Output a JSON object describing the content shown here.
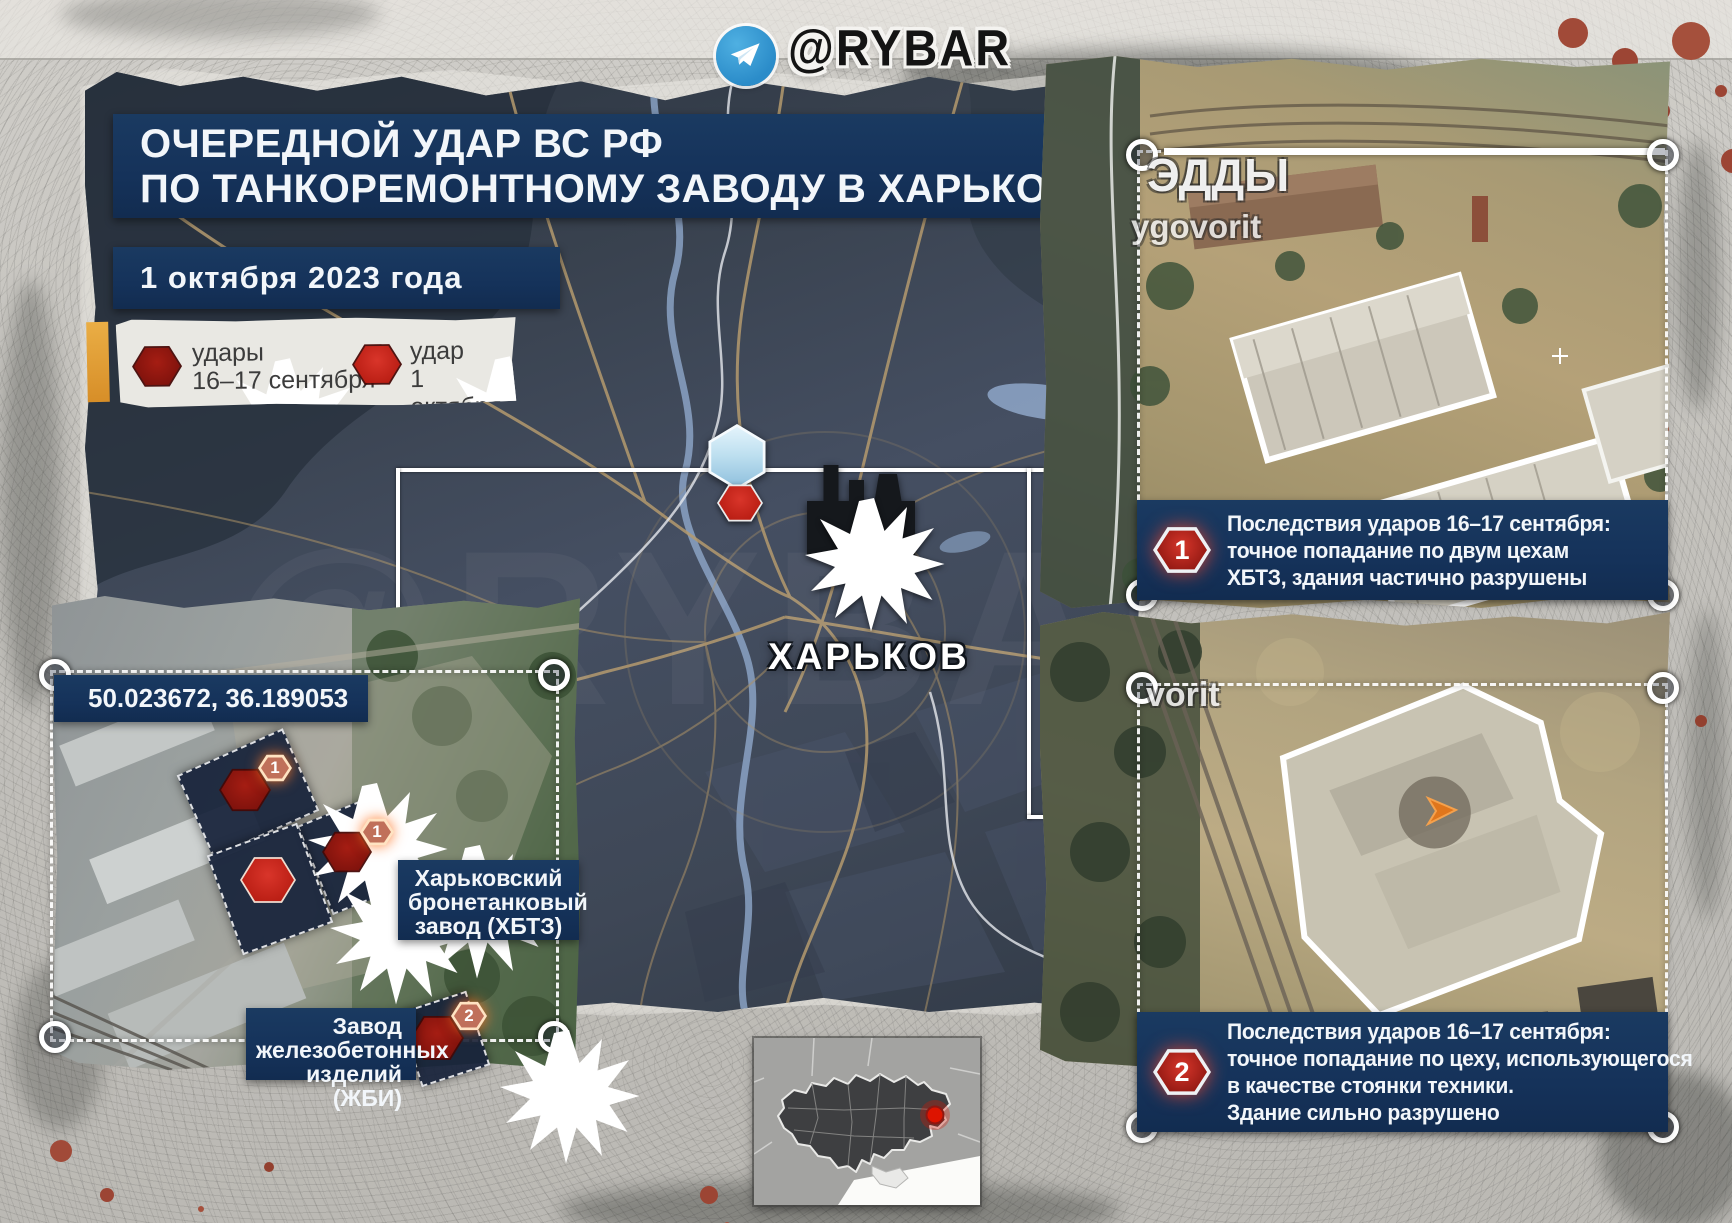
{
  "header": {
    "channel_handle": "@RYBAR"
  },
  "title": {
    "line1": "ОЧЕРЕДНОЙ УДАР ВС РФ",
    "line2": "ПО ТАНКОРЕМОНТНОМУ ЗАВОДУ В ХАРЬКОВЕ"
  },
  "date_label": "1 октября 2023 года",
  "legend": {
    "item1": {
      "label_line1": "удары",
      "label_line2": "16–17 сентября"
    },
    "item2": {
      "label_line1": "удар",
      "label_line2": "1 октября"
    }
  },
  "map": {
    "city_label": "ХАРЬКОВ"
  },
  "inset_top_right": {
    "watermark_big": "ЭДДЫ",
    "watermark_small": "ygovorit",
    "caption_number": "1",
    "caption_line1": "Последствия ударов 16–17 сентября:",
    "caption_line2": "точное попадание по двум цехам",
    "caption_line3": "ХБТЗ, здания частично разрушены"
  },
  "inset_bottom_right": {
    "watermark": "vorit",
    "caption_number": "2",
    "caption_line1": "Последствия ударов 16–17 сентября:",
    "caption_line2": "точное попадание по цеху, использующегося",
    "caption_line3": "в качестве стоянки техники.",
    "caption_line4": "Здание сильно разрушено"
  },
  "inset_bottom_left": {
    "coordinates": "50.023672, 36.189053",
    "label_khbtz_line1": "Харьковский",
    "label_khbtz_line2": "бронетанковый",
    "label_khbtz_line3": "завод (ХБТЗ)",
    "label_zhbi_line1": "Завод",
    "label_zhbi_line2": "железобетонных",
    "label_zhbi_line3": "изделий (ЖБИ)",
    "marker1_number": "1",
    "marker2_number": "1",
    "marker3_number": "2"
  },
  "colors": {
    "accent_navy": "#15325a",
    "strike_dark_red": "#8e1711",
    "strike_red": "#c42318",
    "telegram_blue": "#2f9bd8",
    "legend_accent_orange": "#df9a32",
    "minimap_dot": "#dd1400"
  }
}
